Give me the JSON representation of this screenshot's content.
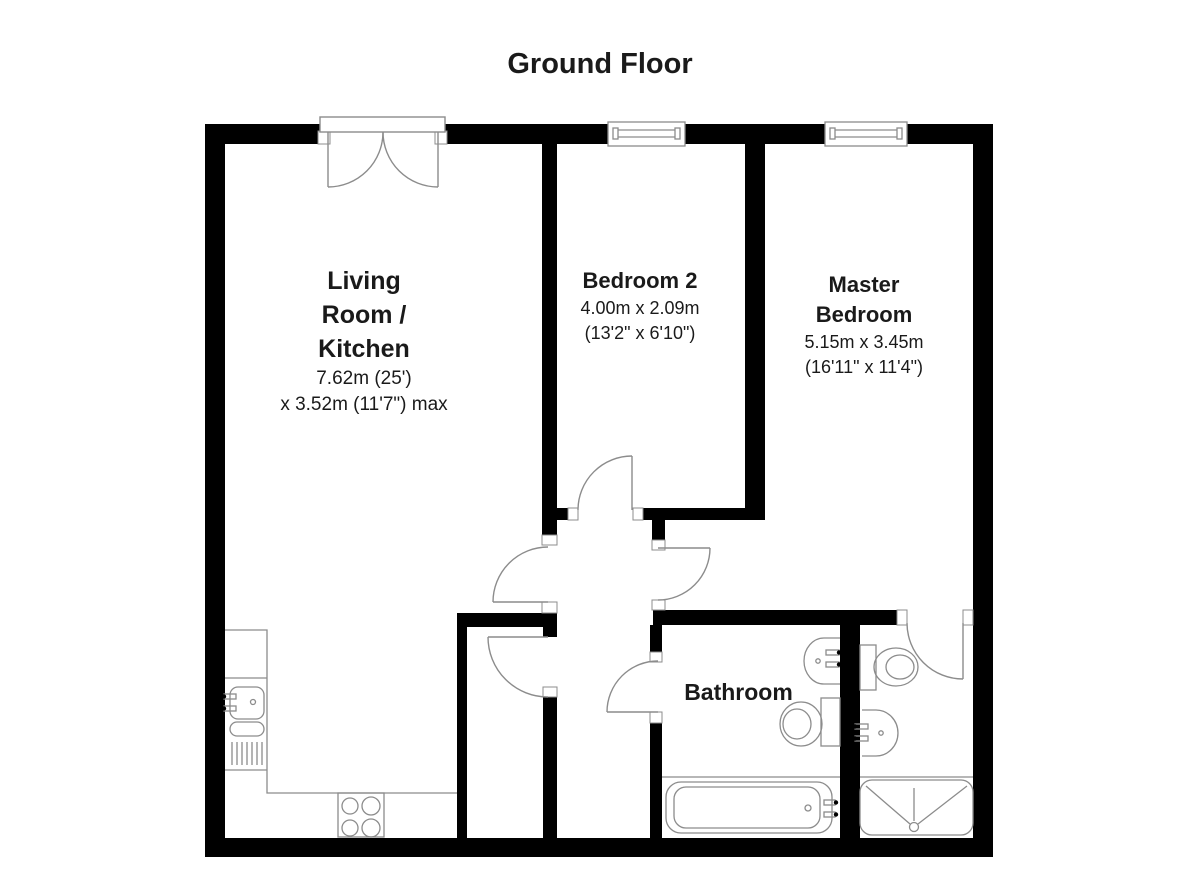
{
  "title": "Ground Floor",
  "rooms": {
    "living_kitchen": {
      "name_lines": [
        "Living",
        "Room /",
        "Kitchen"
      ],
      "dims_line1": "7.62m (25')",
      "dims_line2": "x 3.52m (11'7\") max"
    },
    "bedroom2": {
      "name": "Bedroom 2",
      "dims_metric": "4.00m x 2.09m",
      "dims_imperial": "(13'2\" x 6'10\")"
    },
    "master_bedroom": {
      "name_lines": [
        "Master",
        "Bedroom"
      ],
      "dims_metric": "5.15m x 3.45m",
      "dims_imperial": "(16'11\" x 11'4\")"
    },
    "bathroom": {
      "name": "Bathroom"
    }
  },
  "fixtures": [
    "french-doors",
    "window-bedroom2",
    "window-master-bedroom",
    "kitchen-sink",
    "kitchen-hob",
    "bathtub",
    "bathroom-toilet",
    "bathroom-basin",
    "ensuite-toilet",
    "ensuite-basin",
    "shower-tray"
  ],
  "colors": {
    "wall": "#000000",
    "fixture_line": "#8c8c8c",
    "text": "#1a1a1a",
    "background": "#ffffff"
  }
}
